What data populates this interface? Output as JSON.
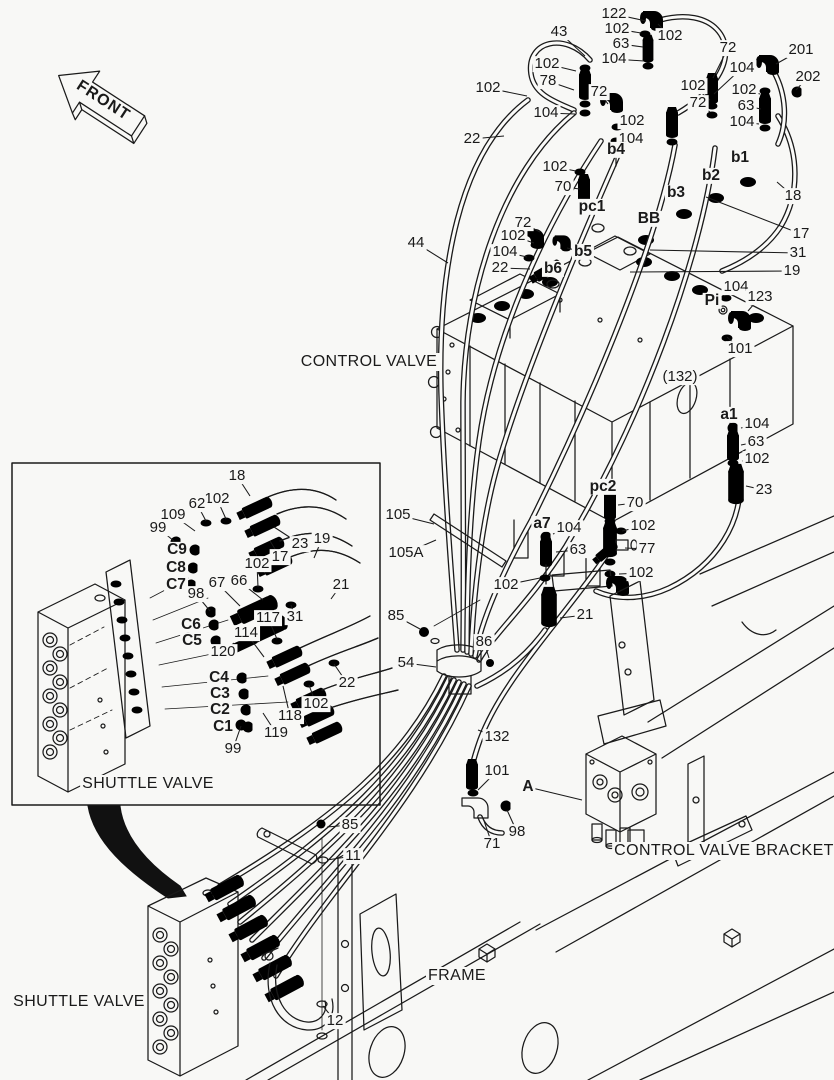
{
  "colors": {
    "background": "#f8f8f6",
    "ink": "#1a1a1a"
  },
  "diagram": {
    "front_marker": {
      "text": "FRONT",
      "x": 103,
      "y": 101,
      "rotation": 33
    },
    "part_names": [
      {
        "text": "CONTROL VALVE",
        "x": 369,
        "y": 362
      },
      {
        "text": "SHUTTLE VALVE",
        "x": 148,
        "y": 784
      },
      {
        "text": "SHUTTLE VALVE",
        "x": 79,
        "y": 1002
      },
      {
        "text": "FRAME",
        "x": 457,
        "y": 976
      },
      {
        "text": "CONTROL VALVE BRACKET",
        "x": 724,
        "y": 851
      }
    ],
    "callouts": [
      {
        "t": "122",
        "x": 614,
        "y": 14,
        "lx": 646,
        "ly": 21
      },
      {
        "t": "102",
        "x": 617,
        "y": 29,
        "lx": 641,
        "ly": 33
      },
      {
        "t": "63",
        "x": 621,
        "y": 44,
        "lx": 643,
        "ly": 47
      },
      {
        "t": "104",
        "x": 614,
        "y": 59,
        "lx": 644,
        "ly": 61
      },
      {
        "t": "102",
        "x": 670,
        "y": 36,
        "lx": 658,
        "ly": 24
      },
      {
        "t": "43",
        "x": 559,
        "y": 32,
        "lx": 585,
        "ly": 56
      },
      {
        "t": "72",
        "x": 728,
        "y": 48,
        "lx": 713,
        "ly": 78
      },
      {
        "t": "201",
        "x": 801,
        "y": 50,
        "lx": 776,
        "ly": 64
      },
      {
        "t": "104",
        "x": 742,
        "y": 68,
        "lx": 714,
        "ly": 94
      },
      {
        "t": "202",
        "x": 808,
        "y": 77,
        "lx": 796,
        "ly": 90
      },
      {
        "t": "102",
        "x": 693,
        "y": 86,
        "lx": 710,
        "ly": 100
      },
      {
        "t": "102",
        "x": 744,
        "y": 90,
        "lx": 760,
        "ly": 94
      },
      {
        "t": "72",
        "x": 698,
        "y": 103,
        "lx": 710,
        "ly": 112
      },
      {
        "t": "63",
        "x": 746,
        "y": 106,
        "lx": 761,
        "ly": 109
      },
      {
        "t": "104",
        "x": 742,
        "y": 122,
        "lx": 759,
        "ly": 124
      },
      {
        "t": "102",
        "x": 547,
        "y": 64,
        "lx": 576,
        "ly": 71
      },
      {
        "t": "78",
        "x": 548,
        "y": 81,
        "lx": 574,
        "ly": 90
      },
      {
        "t": "72",
        "x": 599,
        "y": 92,
        "lx": 608,
        "ly": 104
      },
      {
        "t": "102",
        "x": 488,
        "y": 88,
        "lx": 527,
        "ly": 96
      },
      {
        "t": "104",
        "x": 546,
        "y": 113,
        "lx": 575,
        "ly": 114
      },
      {
        "t": "22",
        "x": 472,
        "y": 139,
        "lx": 504,
        "ly": 136
      },
      {
        "t": "102",
        "x": 632,
        "y": 121,
        "lx": 619,
        "ly": 126
      },
      {
        "t": "104",
        "x": 631,
        "y": 139,
        "lx": 618,
        "ly": 142
      },
      {
        "t": "b4",
        "x": 616,
        "y": 150,
        "b": 1
      },
      {
        "t": "102",
        "x": 555,
        "y": 167,
        "lx": 576,
        "ly": 171
      },
      {
        "t": "70",
        "x": 563,
        "y": 187,
        "lx": 580,
        "ly": 189
      },
      {
        "t": "pc1",
        "x": 592,
        "y": 207,
        "b": 1
      },
      {
        "t": "b3",
        "x": 676,
        "y": 193,
        "b": 1
      },
      {
        "t": "b2",
        "x": 711,
        "y": 176,
        "b": 1
      },
      {
        "t": "b1",
        "x": 740,
        "y": 158,
        "b": 1
      },
      {
        "t": "18",
        "x": 793,
        "y": 196,
        "lx": 777,
        "ly": 182
      },
      {
        "t": "BB",
        "x": 649,
        "y": 219,
        "b": 1
      },
      {
        "t": "17",
        "x": 801,
        "y": 234,
        "lx": 706,
        "ly": 197
      },
      {
        "t": "31",
        "x": 798,
        "y": 253,
        "lx": 650,
        "ly": 250
      },
      {
        "t": "19",
        "x": 792,
        "y": 271,
        "lx": 630,
        "ly": 272
      },
      {
        "t": "44",
        "x": 416,
        "y": 243,
        "lx": 448,
        "ly": 263
      },
      {
        "t": "72",
        "x": 523,
        "y": 223,
        "lx": 540,
        "ly": 232
      },
      {
        "t": "102",
        "x": 513,
        "y": 236,
        "lx": 534,
        "ly": 243
      },
      {
        "t": "104",
        "x": 505,
        "y": 252,
        "lx": 527,
        "ly": 257
      },
      {
        "t": "22",
        "x": 500,
        "y": 268,
        "lx": 530,
        "ly": 269
      },
      {
        "t": "b6",
        "x": 553,
        "y": 269,
        "b": 1
      },
      {
        "t": "b5",
        "x": 583,
        "y": 252,
        "b": 1,
        "lx": 567,
        "ly": 248
      },
      {
        "t": "104",
        "x": 736,
        "y": 287,
        "lx": 724,
        "ly": 296
      },
      {
        "t": "Pi",
        "x": 712,
        "y": 301,
        "b": 1
      },
      {
        "t": "123",
        "x": 760,
        "y": 297,
        "lx": 748,
        "ly": 311
      },
      {
        "t": "101",
        "x": 740,
        "y": 349,
        "lx": 727,
        "ly": 337
      },
      {
        "t": "(132)",
        "x": 680,
        "y": 377
      },
      {
        "t": "a1",
        "x": 729,
        "y": 415,
        "b": 1
      },
      {
        "t": "104",
        "x": 757,
        "y": 424,
        "lx": 741,
        "ly": 428
      },
      {
        "t": "63",
        "x": 756,
        "y": 442,
        "lx": 741,
        "ly": 445
      },
      {
        "t": "102",
        "x": 757,
        "y": 459,
        "lx": 742,
        "ly": 461
      },
      {
        "t": "23",
        "x": 764,
        "y": 490,
        "lx": 746,
        "ly": 486
      },
      {
        "t": "pc2",
        "x": 603,
        "y": 487,
        "b": 1
      },
      {
        "t": "70",
        "x": 635,
        "y": 503,
        "lx": 618,
        "ly": 505
      },
      {
        "t": "a7",
        "x": 542,
        "y": 524,
        "b": 1
      },
      {
        "t": "104",
        "x": 569,
        "y": 528,
        "lx": 553,
        "ly": 534
      },
      {
        "t": "102",
        "x": 643,
        "y": 526,
        "lx": 622,
        "ly": 531
      },
      {
        "t": "63",
        "x": 578,
        "y": 550,
        "lx": 556,
        "ly": 552
      },
      {
        "t": "77",
        "x": 647,
        "y": 549,
        "lx": 625,
        "ly": 548
      },
      {
        "t": "102",
        "x": 641,
        "y": 573,
        "lx": 619,
        "ly": 574
      },
      {
        "t": "102",
        "x": 506,
        "y": 585,
        "lx": 540,
        "ly": 578
      },
      {
        "t": "105",
        "x": 398,
        "y": 515,
        "lx": 434,
        "ly": 524
      },
      {
        "t": "105A",
        "x": 406,
        "y": 553,
        "lx": 436,
        "ly": 540
      },
      {
        "t": "85",
        "x": 396,
        "y": 616,
        "lx": 420,
        "ly": 629
      },
      {
        "t": "86",
        "x": 484,
        "y": 642,
        "lx": 489,
        "ly": 658
      },
      {
        "t": "54",
        "x": 406,
        "y": 663,
        "lx": 436,
        "ly": 667
      },
      {
        "t": "21",
        "x": 585,
        "y": 615,
        "lx": 560,
        "ly": 618
      },
      {
        "t": "132",
        "x": 497,
        "y": 737,
        "lx": 478,
        "ly": 730
      },
      {
        "t": "101",
        "x": 497,
        "y": 771,
        "lx": 478,
        "ly": 790
      },
      {
        "t": "A",
        "x": 528,
        "y": 787,
        "b": 1,
        "lx": 582,
        "ly": 800
      },
      {
        "t": "98",
        "x": 517,
        "y": 832,
        "lx": 507,
        "ly": 810
      },
      {
        "t": "71",
        "x": 492,
        "y": 844,
        "lx": 483,
        "ly": 818
      },
      {
        "t": "85",
        "x": 350,
        "y": 825,
        "lx": 327,
        "ly": 827
      },
      {
        "t": "11",
        "x": 353,
        "y": 856,
        "lx": 327,
        "ly": 860
      },
      {
        "t": "12",
        "x": 335,
        "y": 1021,
        "lx": 323,
        "ly": 1006
      },
      {
        "t": "18",
        "x": 237,
        "y": 476,
        "lx": 250,
        "ly": 496
      },
      {
        "t": "102",
        "x": 217,
        "y": 499,
        "lx": 226,
        "ly": 519
      },
      {
        "t": "62",
        "x": 197,
        "y": 504,
        "lx": 206,
        "ly": 521
      },
      {
        "t": "109",
        "x": 173,
        "y": 515,
        "lx": 195,
        "ly": 531
      },
      {
        "t": "99",
        "x": 158,
        "y": 528,
        "lx": 174,
        "ly": 541
      },
      {
        "t": "C9",
        "x": 177,
        "y": 550,
        "b": 1
      },
      {
        "t": "C8",
        "x": 176,
        "y": 568,
        "b": 1
      },
      {
        "t": "C7",
        "x": 176,
        "y": 585,
        "b": 1
      },
      {
        "t": "23",
        "x": 300,
        "y": 544,
        "lx": 274,
        "ly": 527
      },
      {
        "t": "19",
        "x": 322,
        "y": 539,
        "lx": 314,
        "ly": 558
      },
      {
        "t": "17",
        "x": 280,
        "y": 557,
        "lx": 270,
        "ly": 541
      },
      {
        "t": "102",
        "x": 257,
        "y": 564,
        "lx": 258,
        "ly": 587
      },
      {
        "t": "67",
        "x": 217,
        "y": 583,
        "lx": 240,
        "ly": 606
      },
      {
        "t": "66",
        "x": 239,
        "y": 581,
        "lx": 263,
        "ly": 600
      },
      {
        "t": "98",
        "x": 196,
        "y": 594,
        "lx": 210,
        "ly": 611
      },
      {
        "t": "21",
        "x": 341,
        "y": 585,
        "lx": 331,
        "ly": 599
      },
      {
        "t": "C6",
        "x": 191,
        "y": 625,
        "b": 1
      },
      {
        "t": "C5",
        "x": 192,
        "y": 641,
        "b": 1
      },
      {
        "t": "120",
        "x": 223,
        "y": 652,
        "lx": 234,
        "ly": 643
      },
      {
        "t": "114",
        "x": 246,
        "y": 633,
        "lx": 264,
        "ly": 657
      },
      {
        "t": "117",
        "x": 268,
        "y": 618,
        "lx": 277,
        "ly": 639
      },
      {
        "t": "31",
        "x": 295,
        "y": 617,
        "lx": 291,
        "ly": 605
      },
      {
        "t": "C4",
        "x": 219,
        "y": 678,
        "b": 1
      },
      {
        "t": "C3",
        "x": 220,
        "y": 694,
        "b": 1
      },
      {
        "t": "C2",
        "x": 220,
        "y": 710,
        "b": 1
      },
      {
        "t": "C1",
        "x": 223,
        "y": 727,
        "b": 1
      },
      {
        "t": "22",
        "x": 347,
        "y": 683,
        "lx": 334,
        "ly": 664
      },
      {
        "t": "102",
        "x": 316,
        "y": 704,
        "lx": 309,
        "ly": 685
      },
      {
        "t": "118",
        "x": 290,
        "y": 716,
        "lx": 283,
        "ly": 686
      },
      {
        "t": "119",
        "x": 276,
        "y": 733,
        "lx": 263,
        "ly": 713
      },
      {
        "t": "99",
        "x": 233,
        "y": 749,
        "lx": 241,
        "ly": 726
      }
    ]
  }
}
